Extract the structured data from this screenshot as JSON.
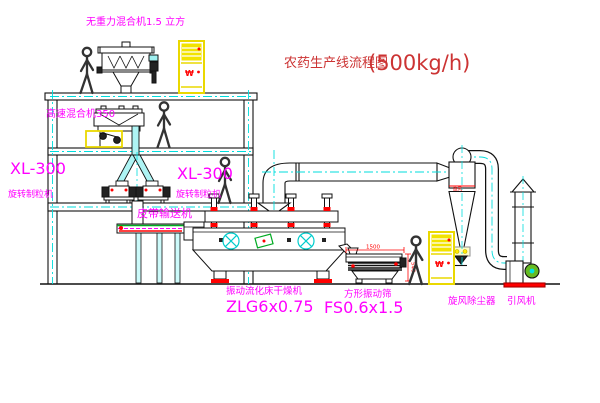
{
  "title": {
    "main": "农药生产线流程图",
    "capacity": "(500kg/h)"
  },
  "labels": {
    "top_mixer": "无重力混合机1.5 立方",
    "high_speed_mixer": "高速混合机350",
    "granulator_left_model": "XL-300",
    "granulator_left_name": "旋转制粒机",
    "granulator_right_model": "XL-300",
    "granulator_right_name": "旋转制粒机",
    "belt_conveyor": "皮带输送机",
    "dryer_name": "振动流化床干燥机",
    "dryer_model": "ZLG6x0.75",
    "sieve_name": "方形振动筛",
    "sieve_model": "FS0.6x1.5",
    "cyclone_name": "旋风除尘器",
    "fan_name": "引风机",
    "cyclone_band_tag": "旋风",
    "cabinet_mark": "₩"
  },
  "dimensions": {
    "sieve_length": "1500",
    "sieve_height": "540"
  },
  "colors": {
    "label_magenta": "#ff00ff",
    "title_red": "#cc3333",
    "dimension_red": "#ff0000",
    "centerline_cyan": "#00dddd",
    "cabinet_yellow": "#f0e000",
    "belt_green": "#00aa22",
    "alarm_red": "#ff0000"
  }
}
